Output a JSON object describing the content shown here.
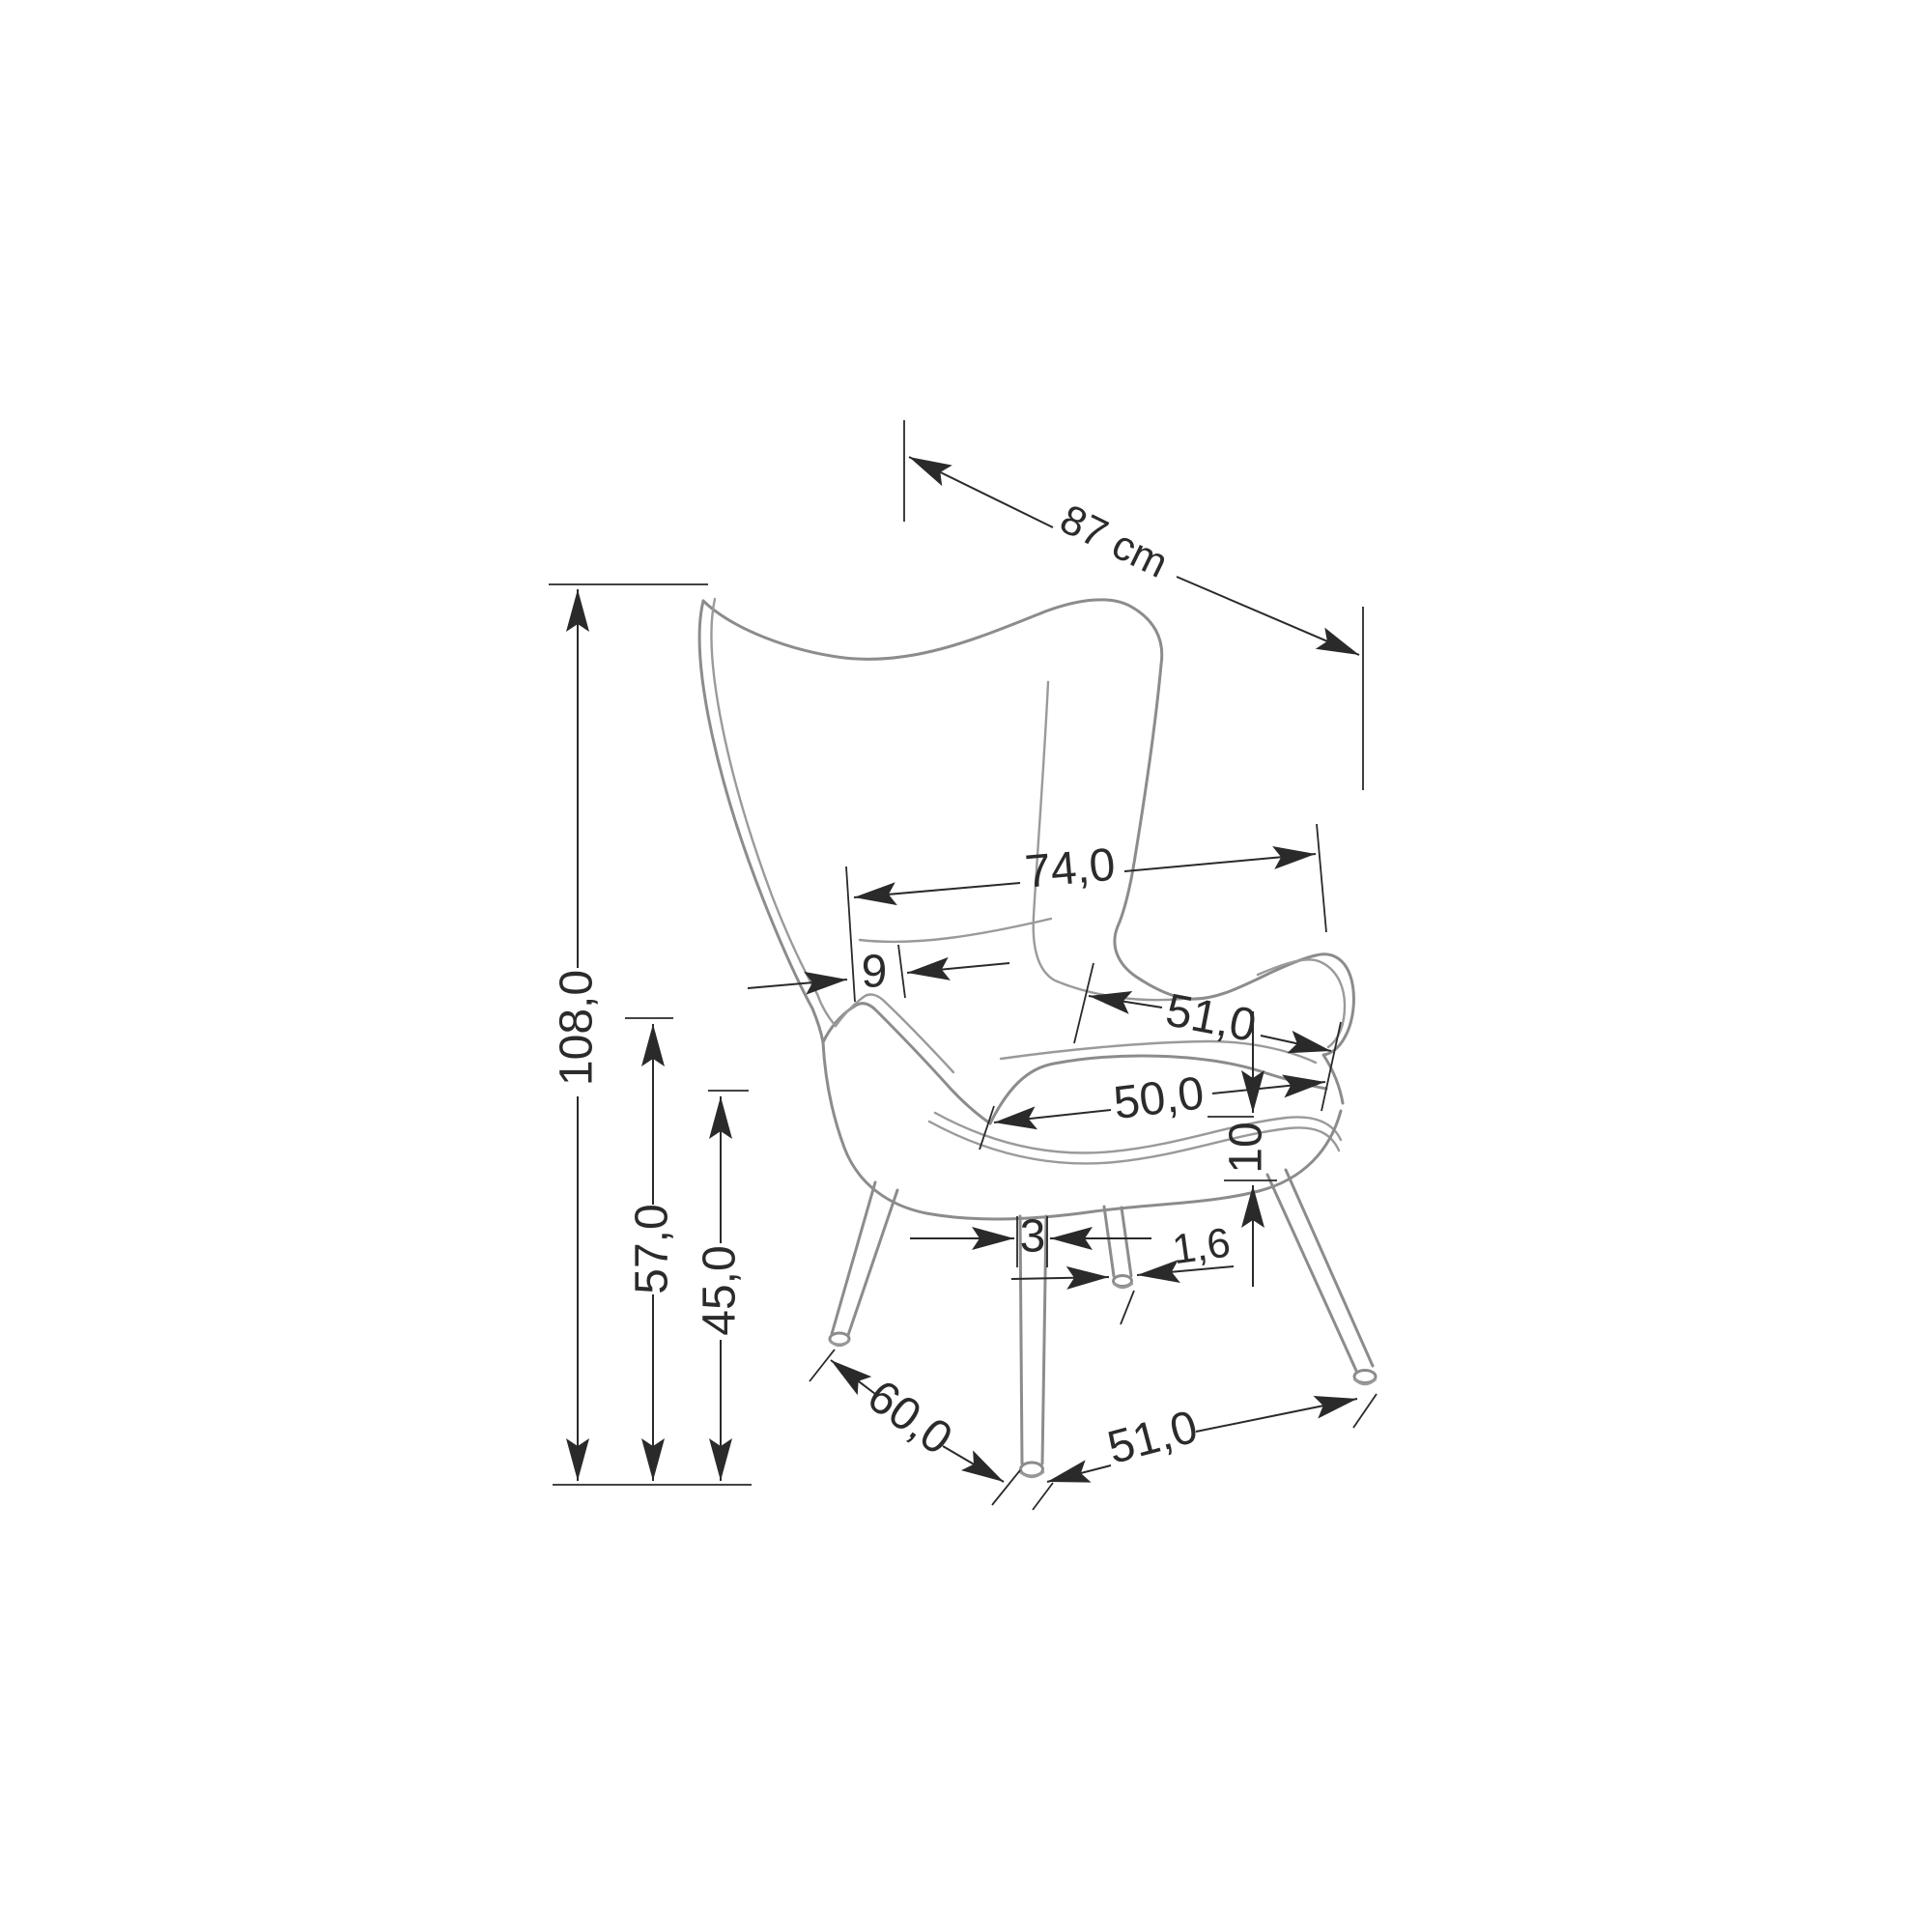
{
  "drawing": {
    "type": "furniture dimension drawing",
    "subject": "wingback armchair with splayed metal legs, three-quarter perspective line drawing",
    "background_color": "#ffffff",
    "outline_color": "#8c8c8c",
    "dimension_color": "#2a2a2a",
    "unit": "cm",
    "labels": {
      "overall_depth": "87 cm",
      "overall_height": "108,0",
      "armrest_height": "57,0",
      "seat_height": "45,0",
      "back_width": "74,0",
      "back_side_thickness": "9",
      "seat_depth": "51,0",
      "seat_width": "50,0",
      "seat_frame_thickness": "10",
      "leg_top_width": "3",
      "foot_diameter": "1,6",
      "leg_spread_side": "60,0",
      "leg_spread_front": "51,0"
    }
  }
}
